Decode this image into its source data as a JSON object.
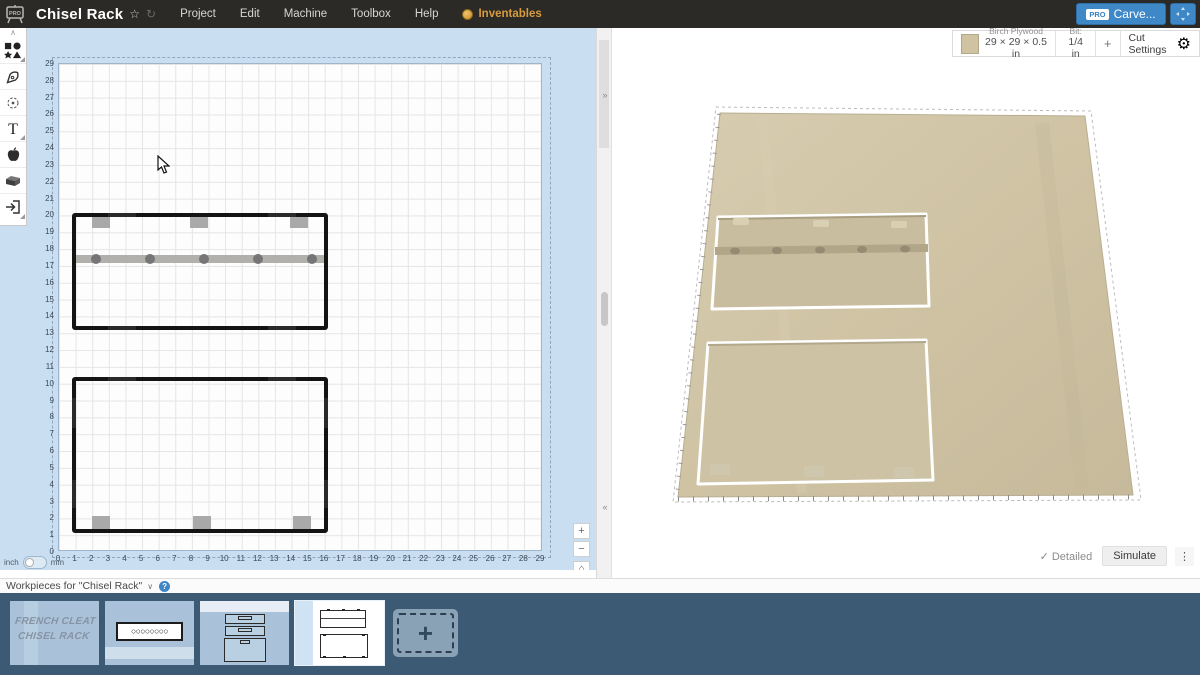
{
  "topbar": {
    "title": "Chisel Rack",
    "menus": [
      "Project",
      "Edit",
      "Machine",
      "Toolbox",
      "Help"
    ],
    "inventables_label": "Inventables",
    "carve": {
      "pro_badge": "PRO",
      "label": "Carve..."
    }
  },
  "icons": {
    "star": "☆",
    "sync": "↻",
    "zoom_in": "+",
    "zoom_out": "−",
    "home": "⌂",
    "collapse_right": "»",
    "collapse_left": "«",
    "dots_vertical": "⋮",
    "check": "✓",
    "chevron_down": "∨",
    "chevron_up": "∧",
    "help": "?",
    "gear": "⚙"
  },
  "canvas": {
    "tick_labels": [
      0,
      1,
      2,
      3,
      4,
      5,
      6,
      7,
      8,
      9,
      10,
      11,
      12,
      13,
      14,
      15,
      16,
      17,
      18,
      19,
      20,
      21,
      22,
      23,
      24,
      25,
      26,
      27,
      28,
      29
    ],
    "unit_left": "inch",
    "unit_right": "mm"
  },
  "material_bar": {
    "material_name": "Birch Plywood",
    "material_dims": "29 × 29 × 0.5 in",
    "bit_label": "Bit:",
    "bit_value": "1/4 in",
    "add_label": "+",
    "cut_settings_label": "Cut Settings"
  },
  "preview": {
    "detailed_label": "Detailed",
    "simulate_label": "Simulate"
  },
  "workpieces": {
    "label": "Workpieces for \"Chisel Rack\"",
    "tile1_line1": "FRENCH CLEAT",
    "tile1_line2": "CHISEL RACK",
    "tile2_scallops": "○○○○○○○○",
    "add_label": "+"
  },
  "colors": {
    "topbar_bg": "#2b2a27",
    "accent_blue": "#3e88c7",
    "canvas_blue": "#c9def1",
    "wood": "#cdc1a2",
    "wood_dark": "#b2a689",
    "tiles_bg": "#3d5a74",
    "inventables_gold": "#d79b3e",
    "gear_green": "#2f9e5f"
  }
}
